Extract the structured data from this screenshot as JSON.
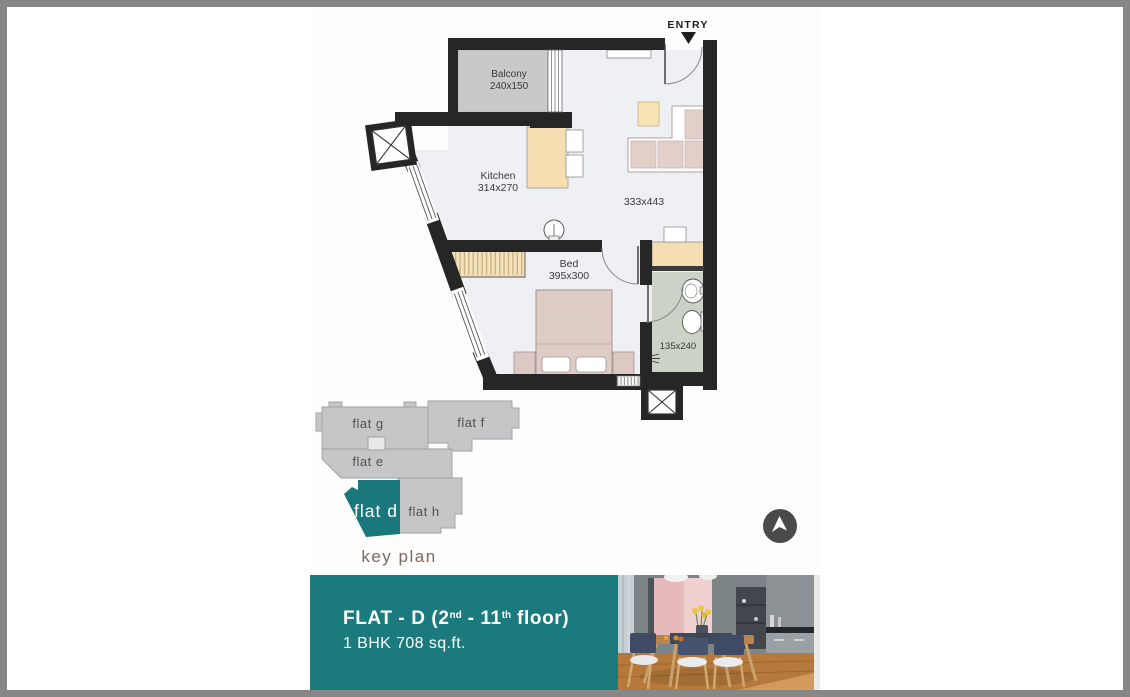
{
  "floor_plan": {
    "entry_label": "ENTRY",
    "balcony": {
      "name": "Balcony",
      "dims": "240x150"
    },
    "kitchen": {
      "name": "Kitchen",
      "dims": "314x270"
    },
    "living": {
      "dims": "333x443"
    },
    "bedroom": {
      "name": "Bed",
      "dims": "395x300"
    },
    "bathroom": {
      "dims": "135x240"
    }
  },
  "key_plan": {
    "title": "key plan",
    "flats": [
      {
        "label": "flat g",
        "highlighted": false
      },
      {
        "label": "flat f",
        "highlighted": false
      },
      {
        "label": "flat e",
        "highlighted": false
      },
      {
        "label": "flat d",
        "highlighted": true
      },
      {
        "label": "flat h",
        "highlighted": false
      }
    ]
  },
  "navigation_button": {
    "icon": "navigation-arrow-icon"
  },
  "banner": {
    "title_prefix": "FLAT - D (2",
    "title_sup1": "nd",
    "title_mid": " - 11",
    "title_sup2": "th",
    "title_suffix": " floor)",
    "subtitle": "1 BHK 708 sq.ft."
  },
  "colors": {
    "teal_accent": "#1b7a7e",
    "key_plan_highlight": "#1a787c",
    "key_plan_gray": "#c6c6c8",
    "wall_black": "#262626",
    "key_plan_title_text": "#7c695e",
    "frame_gray": "#878787"
  }
}
